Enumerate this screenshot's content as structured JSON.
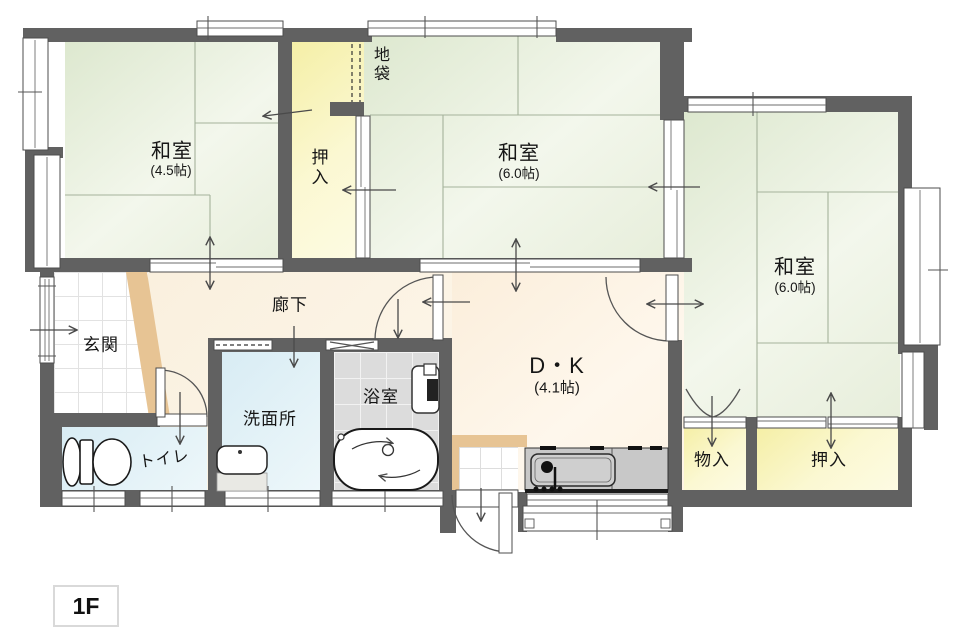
{
  "floor": {
    "label": "1F"
  },
  "rooms": {
    "washitsu_nw": {
      "name": "和室",
      "size": "(4.5帖)"
    },
    "washitsu_n": {
      "name": "和室",
      "size": "(6.0帖)"
    },
    "washitsu_e": {
      "name": "和室",
      "size": "(6.0帖)"
    },
    "dk": {
      "name": "D・K",
      "size": "(4.1帖)"
    },
    "genkan": {
      "name": "玄関"
    },
    "rouka": {
      "name": "廊下"
    },
    "toire": {
      "name": "トイレ"
    },
    "senmenjo": {
      "name": "洗面所"
    },
    "yokushitsu": {
      "name": "浴室"
    },
    "oshiire_north": {
      "name": "押入"
    },
    "jibukuro": {
      "name": "地袋"
    },
    "monoire": {
      "name": "物入"
    },
    "oshiire_southeast": {
      "name": "押入"
    }
  },
  "colors": {
    "wall": "#616161",
    "tatami": "#e7efdb",
    "closet_yellow": "#f8f3b4",
    "hallway_cream": "#fbf2e2",
    "wet_room_blue": "#ddeef5",
    "bath_tile_gray": "#dcdcdc",
    "entry_step_tan": "#e7c494"
  }
}
